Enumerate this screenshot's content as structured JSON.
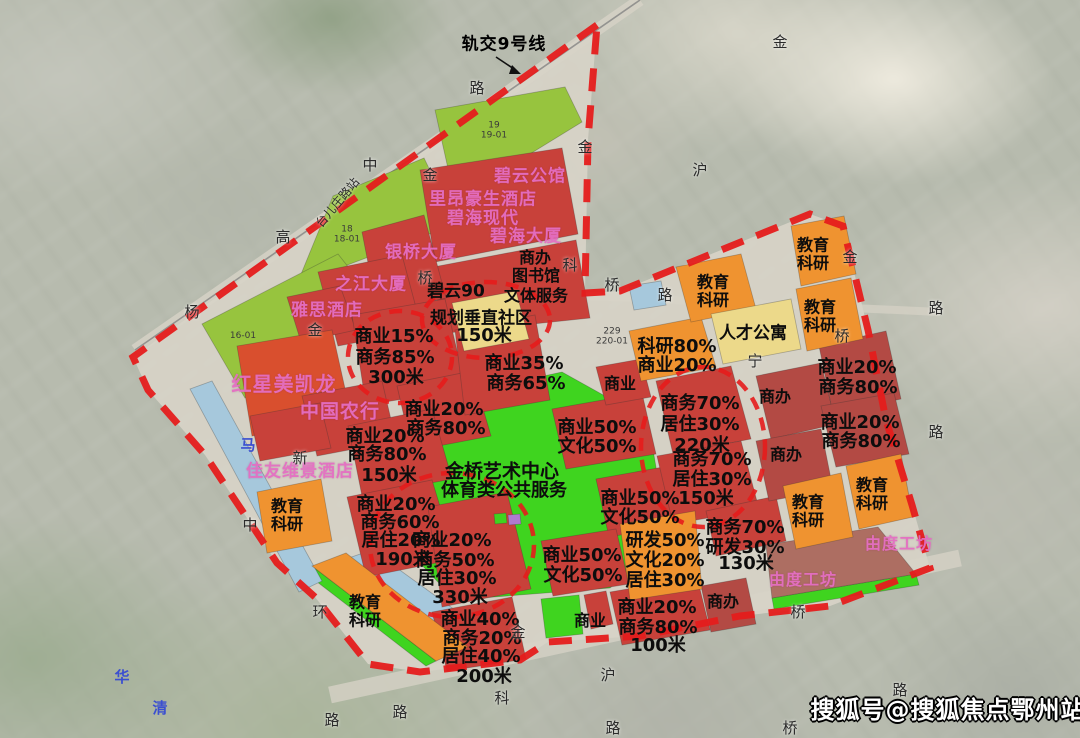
{
  "colors": {
    "park": "#3fd41f",
    "olive": "#97c43e",
    "red": "#c8413a",
    "brightRed": "#d94f2e",
    "darkRed": "#b34a44",
    "orange": "#ef9330",
    "khaki": "#ecd98a",
    "water": "#a6c8dc",
    "brick": "#ad6e62",
    "purple": "#b07ad0",
    "boundary": "#e51c1c",
    "roadFill": "#d7d3c7"
  },
  "geometry": {
    "boundary": "597,25 133,357 148,390 205,455 277,563 315,597 368,664 420,672 520,660 548,642 640,636 740,616 830,606 930,568 912,505 886,420 868,330 843,226 810,214 620,291 585,293 588,140",
    "rail": {
      "x1": 640,
      "y1": 0,
      "x2": 135,
      "y2": 350
    },
    "roads": [
      {
        "x1": 640,
        "y1": 0,
        "x2": 135,
        "y2": 350,
        "w": 12,
        "o": 0.85
      },
      {
        "x1": 330,
        "y1": 695,
        "x2": 960,
        "y2": 558,
        "w": 17,
        "o": 0.8
      },
      {
        "x1": 588,
        "y1": 296,
        "x2": 940,
        "y2": 312,
        "w": 8,
        "o": 0.75
      }
    ],
    "circles": [
      {
        "cx": 400,
        "cy": 357,
        "rx": 52,
        "ry": 46
      },
      {
        "cx": 452,
        "cy": 545,
        "rx": 82,
        "ry": 72
      },
      {
        "cx": 703,
        "cy": 447,
        "rx": 62,
        "ry": 80
      },
      {
        "cx": 486,
        "cy": 320,
        "rx": 64,
        "ry": 38
      }
    ],
    "arrow": {
      "line": "496,57 517,71",
      "head": "512,65 521,74 509,74"
    },
    "zones": [
      {
        "n": "green-strip-19",
        "f": "olive",
        "p": "435,110 565,87 582,122 455,200"
      },
      {
        "n": "green-strip-18",
        "f": "olive",
        "p": "333,196 424,158 456,224 297,284"
      },
      {
        "n": "green-strip-16-01",
        "f": "olive",
        "p": "202,324 338,254 368,292 245,398"
      },
      {
        "n": "central-park",
        "f": "park",
        "p": "470,392 562,372 648,420 668,538 610,588 455,600 398,540 418,440"
      },
      {
        "n": "green-small-1",
        "f": "park",
        "p": "402,596 426,589 436,639 410,647"
      },
      {
        "n": "green-strip-canal",
        "f": "park",
        "p": "303,571 312,566 436,661 426,666"
      },
      {
        "n": "green-bottom",
        "f": "park",
        "p": "541,599 579,595 583,634 546,638"
      },
      {
        "n": "green-youdu-edge",
        "f": "park",
        "p": "772,598 916,574 919,585 774,609"
      },
      {
        "n": "canal-1",
        "f": "water",
        "p": "190,389 212,381 322,581 299,592"
      },
      {
        "n": "canal-2",
        "f": "water",
        "p": "340,561 372,550 502,644 474,657"
      },
      {
        "n": "station-box",
        "f": "water",
        "p": "629,286 661,281 666,305 634,310"
      },
      {
        "n": "block-biyun",
        "f": "red",
        "p": "420,170 562,148 578,234 435,262"
      },
      {
        "n": "block-bihai",
        "f": "red",
        "p": "428,268 576,240 590,318 447,333"
      },
      {
        "n": "block-yinqiao",
        "f": "red",
        "p": "362,232 424,215 446,298 378,314"
      },
      {
        "n": "block-zhijiang",
        "f": "red",
        "p": "318,272 402,255 422,330 338,346"
      },
      {
        "n": "block-yasi",
        "f": "red",
        "p": "287,297 340,286 356,330 301,342"
      },
      {
        "n": "block-c15-b85",
        "f": "red",
        "p": "352,315 445,299 466,389 366,405"
      },
      {
        "n": "block-hongxing",
        "f": "brightRed",
        "p": "237,346 332,330 352,420 252,436"
      },
      {
        "n": "block-nonghang",
        "f": "red",
        "p": "302,396 382,381 396,441 317,456"
      },
      {
        "n": "block-c20-b80-a",
        "f": "red",
        "p": "397,386 472,371 491,436 412,451"
      },
      {
        "n": "block-c35-b65",
        "f": "red",
        "p": "455,330 535,315 550,400 465,415"
      },
      {
        "n": "block-c20-150m",
        "f": "red",
        "p": "348,426 432,409 452,479 362,496"
      },
      {
        "n": "block-jiayou",
        "f": "red",
        "p": "250,416 320,403 331,448 260,461"
      },
      {
        "n": "block-190m",
        "f": "red",
        "p": "347,497 432,480 456,559 366,577"
      },
      {
        "n": "block-330m",
        "f": "red",
        "p": "428,507 507,492 531,589 442,607"
      },
      {
        "n": "block-200m",
        "f": "red",
        "p": "432,612 512,597 526,659 447,671"
      },
      {
        "n": "block-c50-a",
        "f": "red",
        "p": "552,409 642,393 656,454 566,469"
      },
      {
        "n": "block-c50-b",
        "f": "red",
        "p": "596,479 669,466 683,524 609,537"
      },
      {
        "n": "block-c50-c",
        "f": "red",
        "p": "541,541 616,529 629,584 553,596"
      },
      {
        "n": "block-shangye-sm",
        "f": "red",
        "p": "596,367 641,359 651,397 606,405"
      },
      {
        "n": "block-b70-220m",
        "f": "red",
        "p": "656,381 731,366 751,439 673,454"
      },
      {
        "n": "block-b70-150m",
        "f": "red",
        "p": "657,456 741,441 759,509 673,524"
      },
      {
        "n": "block-b70-130m",
        "f": "red",
        "p": "706,511 776,496 786,541 716,556"
      },
      {
        "n": "block-c2080-bottom",
        "f": "red",
        "p": "610,592 697,577 710,630 622,645"
      },
      {
        "n": "block-red-sm-bottom",
        "f": "red",
        "p": "584,595 606,591 613,624 591,629"
      },
      {
        "n": "block-shangban-a",
        "f": "darkRed",
        "p": "756,376 821,363 836,424 771,439"
      },
      {
        "n": "block-shangban-b",
        "f": "darkRed",
        "p": "756,441 821,429 833,489 769,501"
      },
      {
        "n": "block-shangban-c",
        "f": "darkRed",
        "p": "701,586 746,578 756,624 711,632"
      },
      {
        "n": "block-c2080-r1",
        "f": "darkRed",
        "p": "819,346 886,331 901,399 833,414"
      },
      {
        "n": "block-c2080-r2",
        "f": "darkRed",
        "p": "821,406 894,393 909,454 836,467"
      },
      {
        "n": "block-youdu",
        "f": "brick",
        "p": "766,545 878,527 916,574 772,598"
      },
      {
        "n": "edu-left-1",
        "f": "orange",
        "p": "257,492 321,479 332,541 267,553"
      },
      {
        "n": "edu-strip",
        "f": "orange",
        "p": "312,566 346,553 468,647 436,661"
      },
      {
        "n": "edu-yanfa",
        "f": "orange",
        "p": "620,524 695,511 702,589 630,600"
      },
      {
        "n": "edu-keyan80",
        "f": "orange",
        "p": "629,331 701,317 716,367 641,381"
      },
      {
        "n": "edu-ne",
        "f": "orange",
        "p": "676,267 741,254 756,309 691,322"
      },
      {
        "n": "edu-r1",
        "f": "orange",
        "p": "783,486 841,473 853,537 796,549"
      },
      {
        "n": "edu-r2",
        "f": "orange",
        "p": "846,466 901,454 913,517 859,529"
      },
      {
        "n": "edu-fr1",
        "f": "orange",
        "p": "791,226 844,216 856,274 801,286"
      },
      {
        "n": "edu-fr2",
        "f": "orange",
        "p": "796,289 851,278 863,339 807,351"
      },
      {
        "n": "block-biyun90",
        "f": "khaki",
        "p": "452,303 516,291 529,339 464,351"
      },
      {
        "n": "block-rencai",
        "f": "khaki",
        "p": "711,314 791,299 801,349 723,364"
      },
      {
        "n": "legend-green",
        "f": "park",
        "p": "494,514 506,513 507,523 495,524"
      },
      {
        "n": "legend-purple",
        "f": "purple",
        "p": "508,515 520,514 521,524 509,525"
      }
    ]
  },
  "labels": [
    {
      "t": "轨交9号线",
      "x": 504,
      "y": 45,
      "k": "annotation"
    },
    {
      "t": "碧云公馆",
      "x": 530,
      "y": 177,
      "k": "building"
    },
    {
      "t": "里昂豪生酒店",
      "x": 483,
      "y": 200,
      "k": "building"
    },
    {
      "t": "碧海现代",
      "x": 483,
      "y": 219,
      "k": "building"
    },
    {
      "t": "碧海大厦",
      "x": 526,
      "y": 237,
      "k": "building"
    },
    {
      "t": "银桥大厦",
      "x": 421,
      "y": 253,
      "k": "building"
    },
    {
      "t": "之江大厦",
      "x": 371,
      "y": 285,
      "k": "building"
    },
    {
      "t": "雅思酒店",
      "x": 327,
      "y": 311,
      "k": "building"
    },
    {
      "t": "红星美凯龙",
      "x": 284,
      "y": 384,
      "k": "building",
      "s": 20
    },
    {
      "t": "中国农行",
      "x": 340,
      "y": 412,
      "k": "building",
      "s": 19
    },
    {
      "t": "佳友维景酒店",
      "x": 300,
      "y": 472,
      "k": "building"
    },
    {
      "t": "由度工坊",
      "x": 899,
      "y": 544,
      "k": "building",
      "s": 16
    },
    {
      "t": "由度工坊",
      "x": 803,
      "y": 580,
      "k": "building",
      "s": 16
    },
    {
      "t": "商办",
      "x": 535,
      "y": 258,
      "k": "zoning",
      "s": 16
    },
    {
      "t": "图书馆",
      "x": 536,
      "y": 276,
      "k": "zoning",
      "s": 16
    },
    {
      "t": "文体服务",
      "x": 536,
      "y": 296,
      "k": "zoning",
      "s": 16
    },
    {
      "t": "碧云90",
      "x": 456,
      "y": 292,
      "k": "zoning",
      "s": 17
    },
    {
      "t": "规划垂直社区",
      "x": 481,
      "y": 319,
      "k": "zoning",
      "s": 17
    },
    {
      "t": "150米",
      "x": 484,
      "y": 336,
      "k": "zoning"
    },
    {
      "t": "商业15%",
      "x": 394,
      "y": 337,
      "k": "zoning"
    },
    {
      "t": "商务85%",
      "x": 395,
      "y": 358,
      "k": "zoning"
    },
    {
      "t": "300米",
      "x": 396,
      "y": 378,
      "k": "zoning"
    },
    {
      "t": "商业35%",
      "x": 524,
      "y": 364,
      "k": "zoning"
    },
    {
      "t": "商务65%",
      "x": 526,
      "y": 384,
      "k": "zoning"
    },
    {
      "t": "商业20%",
      "x": 444,
      "y": 410,
      "k": "zoning"
    },
    {
      "t": "商务80%",
      "x": 446,
      "y": 429,
      "k": "zoning"
    },
    {
      "t": "商业20%",
      "x": 385,
      "y": 437,
      "k": "zoning"
    },
    {
      "t": "商务80%",
      "x": 387,
      "y": 455,
      "k": "zoning"
    },
    {
      "t": "150米",
      "x": 389,
      "y": 476,
      "k": "zoning"
    },
    {
      "t": "商业20%",
      "x": 396,
      "y": 505,
      "k": "zoning"
    },
    {
      "t": "商务60%",
      "x": 400,
      "y": 523,
      "k": "zoning"
    },
    {
      "t": "居住20%",
      "x": 401,
      "y": 541,
      "k": "zoning"
    },
    {
      "t": "190米",
      "x": 403,
      "y": 560,
      "k": "zoning"
    },
    {
      "t": "商业20%",
      "x": 452,
      "y": 541,
      "k": "zoning"
    },
    {
      "t": "商务50%",
      "x": 455,
      "y": 561,
      "k": "zoning"
    },
    {
      "t": "居住30%",
      "x": 457,
      "y": 579,
      "k": "zoning"
    },
    {
      "t": "330米",
      "x": 460,
      "y": 598,
      "k": "zoning"
    },
    {
      "t": "商业40%",
      "x": 480,
      "y": 620,
      "k": "zoning"
    },
    {
      "t": "商务20%",
      "x": 482,
      "y": 639,
      "k": "zoning"
    },
    {
      "t": "居住40%",
      "x": 481,
      "y": 657,
      "k": "zoning"
    },
    {
      "t": "200米",
      "x": 484,
      "y": 677,
      "k": "zoning"
    },
    {
      "t": "教育\n科研",
      "x": 287,
      "y": 515,
      "k": "zoning",
      "s": 16
    },
    {
      "t": "教育\n科研",
      "x": 365,
      "y": 611,
      "k": "zoning",
      "s": 16
    },
    {
      "t": "金桥艺术中心",
      "x": 502,
      "y": 472,
      "k": "zoning",
      "s": 19
    },
    {
      "t": "体育类公共服务",
      "x": 504,
      "y": 491,
      "k": "zoning",
      "s": 18
    },
    {
      "t": "商业",
      "x": 620,
      "y": 384,
      "k": "zoning",
      "s": 16
    },
    {
      "t": "科研80%",
      "x": 677,
      "y": 347,
      "k": "zoning"
    },
    {
      "t": "商业20%",
      "x": 677,
      "y": 366,
      "k": "zoning"
    },
    {
      "t": "人才公寓",
      "x": 753,
      "y": 334,
      "k": "zoning",
      "s": 17
    },
    {
      "t": "教育\n科研",
      "x": 713,
      "y": 291,
      "k": "zoning",
      "s": 16
    },
    {
      "t": "商务70%",
      "x": 700,
      "y": 404,
      "k": "zoning"
    },
    {
      "t": "居住30%",
      "x": 700,
      "y": 425,
      "k": "zoning"
    },
    {
      "t": "220米",
      "x": 702,
      "y": 446,
      "k": "zoning"
    },
    {
      "t": "商办",
      "x": 775,
      "y": 397,
      "k": "zoning",
      "s": 16
    },
    {
      "t": "商业50%",
      "x": 597,
      "y": 428,
      "k": "zoning"
    },
    {
      "t": "文化50%",
      "x": 597,
      "y": 447,
      "k": "zoning"
    },
    {
      "t": "商务70%",
      "x": 712,
      "y": 460,
      "k": "zoning"
    },
    {
      "t": "居住30%",
      "x": 712,
      "y": 480,
      "k": "zoning"
    },
    {
      "t": "150米",
      "x": 706,
      "y": 499,
      "k": "zoning"
    },
    {
      "t": "商办",
      "x": 786,
      "y": 455,
      "k": "zoning",
      "s": 16
    },
    {
      "t": "商业50%",
      "x": 640,
      "y": 499,
      "k": "zoning"
    },
    {
      "t": "文化50%",
      "x": 640,
      "y": 518,
      "k": "zoning"
    },
    {
      "t": "商务70%",
      "x": 745,
      "y": 528,
      "k": "zoning"
    },
    {
      "t": "研发30%",
      "x": 745,
      "y": 548,
      "k": "zoning"
    },
    {
      "t": "130米",
      "x": 746,
      "y": 564,
      "k": "zoning"
    },
    {
      "t": "研发50%",
      "x": 665,
      "y": 541,
      "k": "zoning"
    },
    {
      "t": "文化20%",
      "x": 665,
      "y": 561,
      "k": "zoning"
    },
    {
      "t": "居住30%",
      "x": 665,
      "y": 581,
      "k": "zoning"
    },
    {
      "t": "商业50%",
      "x": 582,
      "y": 556,
      "k": "zoning"
    },
    {
      "t": "文化50%",
      "x": 583,
      "y": 576,
      "k": "zoning"
    },
    {
      "t": "商业20%",
      "x": 657,
      "y": 608,
      "k": "zoning"
    },
    {
      "t": "商务80%",
      "x": 658,
      "y": 628,
      "k": "zoning"
    },
    {
      "t": "100米",
      "x": 658,
      "y": 646,
      "k": "zoning"
    },
    {
      "t": "商办",
      "x": 723,
      "y": 602,
      "k": "zoning",
      "s": 16
    },
    {
      "t": "商业",
      "x": 590,
      "y": 621,
      "k": "zoning",
      "s": 16
    },
    {
      "t": "商业20%",
      "x": 857,
      "y": 368,
      "k": "zoning"
    },
    {
      "t": "商务80%",
      "x": 858,
      "y": 388,
      "k": "zoning"
    },
    {
      "t": "商业20%",
      "x": 860,
      "y": 423,
      "k": "zoning"
    },
    {
      "t": "商务80%",
      "x": 861,
      "y": 442,
      "k": "zoning"
    },
    {
      "t": "教育\n科研",
      "x": 813,
      "y": 254,
      "k": "zoning",
      "s": 16
    },
    {
      "t": "教育\n科研",
      "x": 820,
      "y": 316,
      "k": "zoning",
      "s": 16
    },
    {
      "t": "教育\n科研",
      "x": 808,
      "y": 511,
      "k": "zoning",
      "s": 16
    },
    {
      "t": "教育\n科研",
      "x": 872,
      "y": 494,
      "k": "zoning",
      "s": 16
    },
    {
      "t": "路",
      "x": 477,
      "y": 88,
      "k": "road"
    },
    {
      "t": "金",
      "x": 585,
      "y": 147,
      "k": "road"
    },
    {
      "t": "金",
      "x": 780,
      "y": 42,
      "k": "road"
    },
    {
      "t": "沪",
      "x": 700,
      "y": 170,
      "k": "road"
    },
    {
      "t": "中",
      "x": 370,
      "y": 165,
      "k": "road"
    },
    {
      "t": "金",
      "x": 430,
      "y": 175,
      "k": "road"
    },
    {
      "t": "高",
      "x": 283,
      "y": 237,
      "k": "road"
    },
    {
      "t": "杨",
      "x": 192,
      "y": 312,
      "k": "road"
    },
    {
      "t": "金",
      "x": 315,
      "y": 330,
      "k": "road"
    },
    {
      "t": "桥",
      "x": 425,
      "y": 278,
      "k": "road"
    },
    {
      "t": "科",
      "x": 570,
      "y": 265,
      "k": "road"
    },
    {
      "t": "桥",
      "x": 612,
      "y": 285,
      "k": "road"
    },
    {
      "t": "路",
      "x": 665,
      "y": 295,
      "k": "road"
    },
    {
      "t": "金",
      "x": 850,
      "y": 257,
      "k": "road"
    },
    {
      "t": "路",
      "x": 936,
      "y": 308,
      "k": "road"
    },
    {
      "t": "桥",
      "x": 842,
      "y": 336,
      "k": "road"
    },
    {
      "t": "宁",
      "x": 755,
      "y": 361,
      "k": "road"
    },
    {
      "t": "路",
      "x": 936,
      "y": 432,
      "k": "road"
    },
    {
      "t": "新",
      "x": 300,
      "y": 458,
      "k": "road"
    },
    {
      "t": "中",
      "x": 250,
      "y": 525,
      "k": "road"
    },
    {
      "t": "环",
      "x": 320,
      "y": 612,
      "k": "road"
    },
    {
      "t": "路",
      "x": 332,
      "y": 720,
      "k": "road"
    },
    {
      "t": "路",
      "x": 400,
      "y": 712,
      "k": "road"
    },
    {
      "t": "金",
      "x": 518,
      "y": 632,
      "k": "road"
    },
    {
      "t": "科",
      "x": 502,
      "y": 698,
      "k": "road"
    },
    {
      "t": "沪",
      "x": 608,
      "y": 675,
      "k": "road"
    },
    {
      "t": "路",
      "x": 613,
      "y": 728,
      "k": "road"
    },
    {
      "t": "桥",
      "x": 798,
      "y": 612,
      "k": "road"
    },
    {
      "t": "桥",
      "x": 790,
      "y": 728,
      "k": "road"
    },
    {
      "t": "路",
      "x": 900,
      "y": 690,
      "k": "road"
    },
    {
      "t": "台儿庄路站",
      "x": 338,
      "y": 203,
      "k": "road",
      "s": 12,
      "r": -50
    },
    {
      "t": "马",
      "x": 248,
      "y": 445,
      "k": "blueroad"
    },
    {
      "t": "华",
      "x": 122,
      "y": 677,
      "k": "blueroad"
    },
    {
      "t": "清",
      "x": 160,
      "y": 708,
      "k": "blueroad"
    },
    {
      "t": "18\n18-01",
      "x": 347,
      "y": 235,
      "k": "parcel"
    },
    {
      "t": "19\n19-01",
      "x": 494,
      "y": 131,
      "k": "parcel"
    },
    {
      "t": "16-01",
      "x": 243,
      "y": 336,
      "k": "parcel"
    },
    {
      "t": "229\n220-01",
      "x": 612,
      "y": 337,
      "k": "parcel"
    },
    {
      "t": "搜狐号@搜狐焦点鄂州站",
      "x": 948,
      "y": 710,
      "k": "watermark"
    }
  ]
}
